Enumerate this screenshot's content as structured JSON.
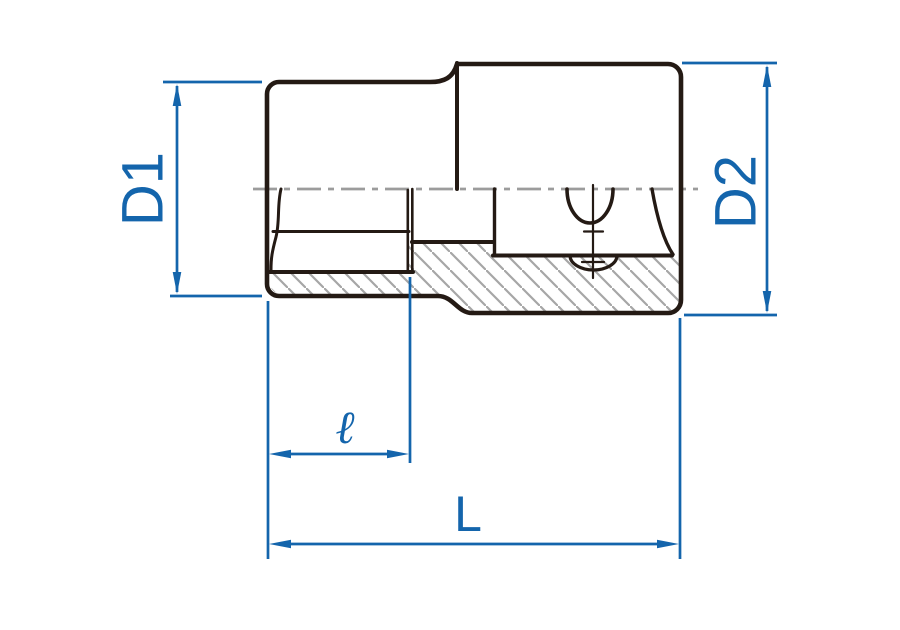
{
  "drawing": {
    "title": "socket-cross-section-dimension-diagram",
    "labels": {
      "d1": "D1",
      "d2": "D2",
      "l_small": "ℓ",
      "l_total": "L"
    }
  },
  "colors": {
    "dimension_blue": "#1465ac",
    "outline_dark": "#241a14",
    "hatch_gray": "#a6a6a6",
    "centerline_gray": "#9c9c9c",
    "background": "#ffffff"
  }
}
